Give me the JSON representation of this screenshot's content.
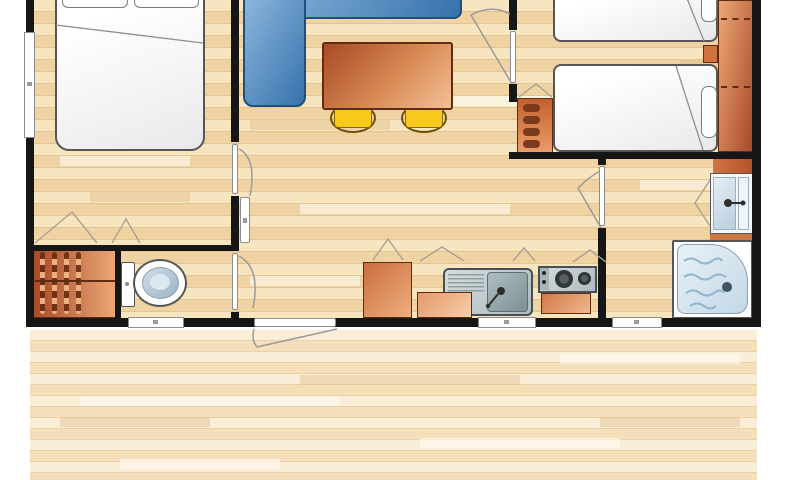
{
  "meta": {
    "description": "Top-down architectural floor plan of a two-bedroom mobile home with front wooden deck; no text labels are rendered in the image",
    "visible_text": []
  },
  "rooms": [
    {
      "name": "bedroom-double",
      "furniture": [
        "double-bed",
        "two-pillows",
        "wardrobe-with-hanging-rail"
      ]
    },
    {
      "name": "wc",
      "furniture": [
        "toilet"
      ]
    },
    {
      "name": "living-kitchen",
      "furniture": [
        "corner-sofa",
        "dining-table",
        "stool",
        "stool",
        "tall-cabinet",
        "sink-unit",
        "counter-unit",
        "two-burner-hob",
        "hob-base-cabinet"
      ]
    },
    {
      "name": "bedroom-twin",
      "furniture": [
        "single-bed",
        "single-bed",
        "nightstand",
        "shelf-unit",
        "wardrobe-with-shelves"
      ]
    },
    {
      "name": "shower-room",
      "furniture": [
        "washbasin-unit",
        "shower-tray"
      ]
    },
    {
      "name": "deck",
      "furniture": []
    }
  ],
  "openings": {
    "windows": 4,
    "interior_doors": 4,
    "entrance_doors": 1
  },
  "colors": {
    "wall": "#161616",
    "wood-a": "#f7e5c0",
    "wood-b": "#efd3a2",
    "wood-line": "#e4c48f",
    "deck-a": "#faeed8",
    "deck-b": "#f4dfba",
    "deck-line": "#ecd0a6",
    "sofa-light": "#8db8dd",
    "sofa-dark": "#3672ad",
    "sofa-border": "#1d4f80",
    "orange-dark": "#a84a25",
    "orange-light": "#f2c096",
    "orange-border": "#5f2c12",
    "yellow": "#f8c81c",
    "yellow-border": "#8a6a00",
    "steel-dark": "#aebbbe",
    "steel-border": "#474f52",
    "fixture-border": "#565656",
    "water-light": "#e8f1f7",
    "water-mid": "#c2d8e6",
    "water-line": "#90b6ce",
    "window-fill": "#ffffff",
    "window-border": "#8c8c8c",
    "line-gray": "#9a9a9a"
  }
}
